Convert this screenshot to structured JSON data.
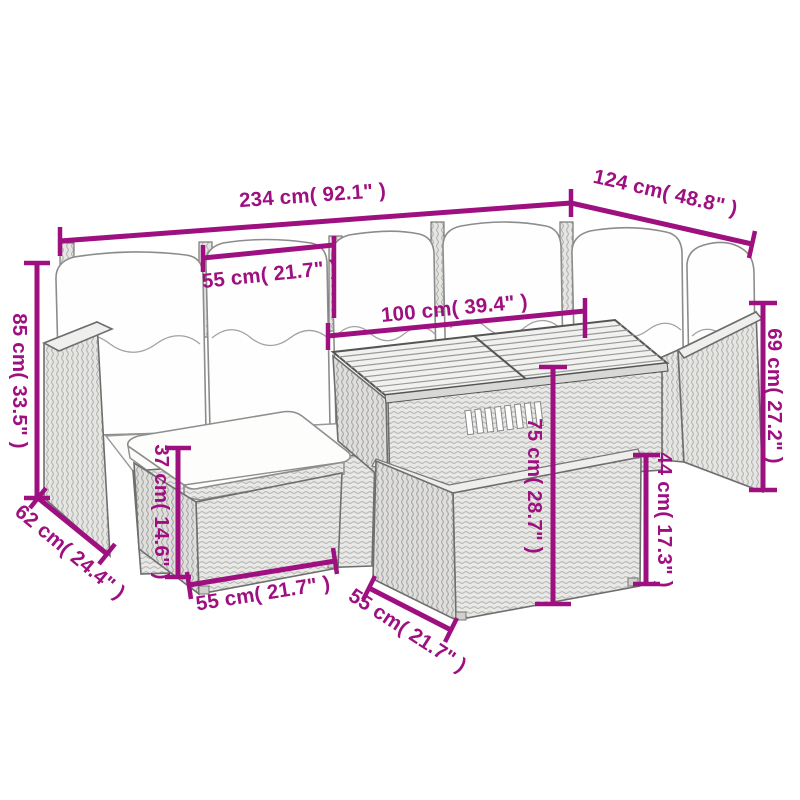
{
  "page": {
    "type": "product-dimension-diagram",
    "subject": "poly-rattan garden corner sofa set with cushions, acacia slat table and ottomans",
    "background": "#ffffff"
  },
  "style": {
    "dimension_color": "#9e1080",
    "furniture_line_color": "#6e6e6e",
    "rattan_fill": "#e8e8e6",
    "cushion_fill": "#fefefe"
  },
  "dimensions": {
    "overall_width": {
      "label": "234 cm( 92.1\" )",
      "cm": 234,
      "inches": 92.1
    },
    "right_section_width": {
      "label": "124 cm( 48.8\" )",
      "cm": 124,
      "inches": 48.8
    },
    "seat_width": {
      "label": "55 cm( 21.7\" )",
      "cm": 55,
      "inches": 21.7
    },
    "table_length": {
      "label": "100 cm( 39.4\" )",
      "cm": 100,
      "inches": 39.4
    },
    "back_height": {
      "label": "85 cm( 33.5\" )",
      "cm": 85,
      "inches": 33.5
    },
    "seat_depth": {
      "label": "62 cm( 24.4\" )",
      "cm": 62,
      "inches": 24.4
    },
    "ottoman_height": {
      "label": "37 cm( 14.6\" )",
      "cm": 37,
      "inches": 14.6
    },
    "ottoman_width": {
      "label": "55 cm( 21.7\" )",
      "cm": 55,
      "inches": 21.7
    },
    "table_height": {
      "label": "75 cm( 28.7\" )",
      "cm": 75,
      "inches": 28.7
    },
    "bench_height": {
      "label": "44 cm( 17.3\" )",
      "cm": 44,
      "inches": 17.3
    },
    "armrest_height": {
      "label": "69 cm( 27.2\" )",
      "cm": 69,
      "inches": 27.2
    },
    "bench_depth": {
      "label": "55 cm( 21.7\" )",
      "cm": 55,
      "inches": 21.7
    }
  }
}
